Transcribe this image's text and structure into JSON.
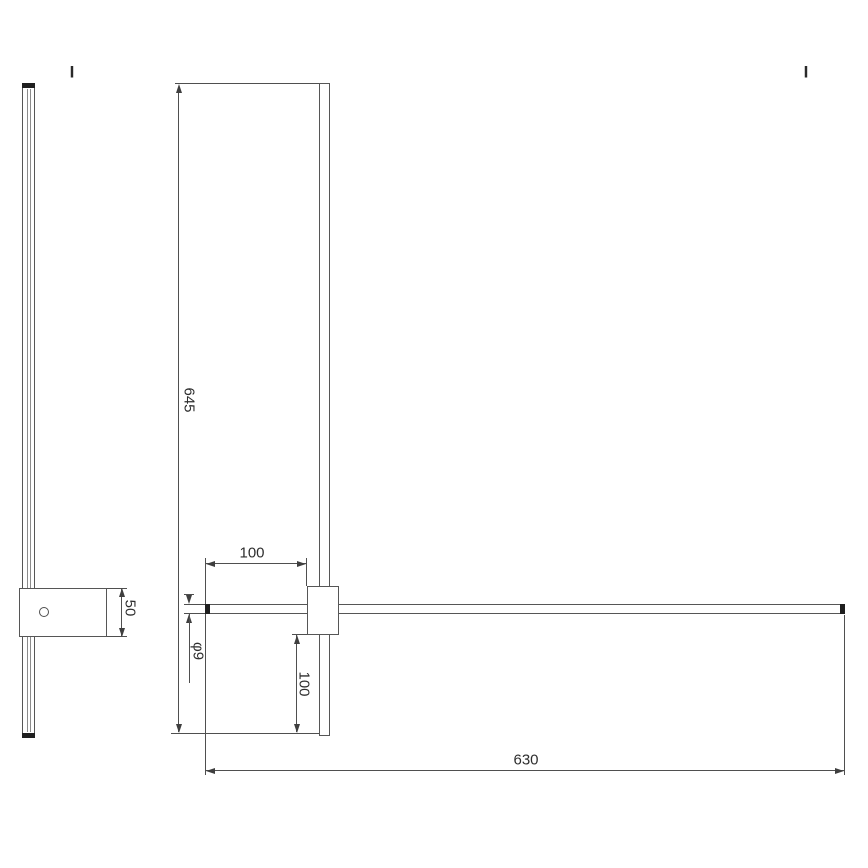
{
  "section_markers": {
    "left": "I",
    "right": "I"
  },
  "dimensions": {
    "tube_length": "645",
    "top_offset": "100",
    "tube_diameter": "φ9",
    "bottom_offset": "100",
    "bar_length": "630",
    "bracket_height": "50"
  },
  "colors": {
    "background": "#ffffff",
    "outline": "#565656",
    "dimension_line": "#4f4f4f",
    "end_cap": "#1f1f1f",
    "text": "#2e2e2e"
  }
}
